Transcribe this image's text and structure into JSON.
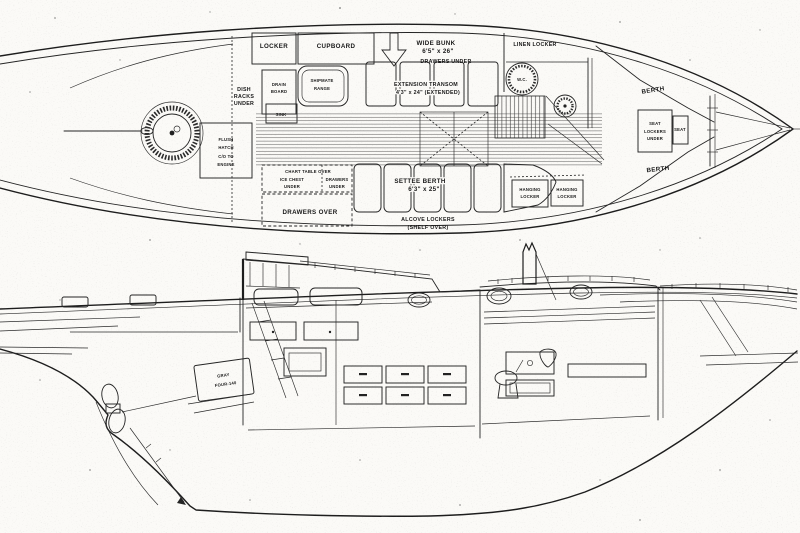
{
  "colors": {
    "ink": "#242424",
    "paper": "#fbfaf7"
  },
  "plan_labels": {
    "locker": "LOCKER",
    "cupboard": "CUPBOARD",
    "wide_bunk_1": "WIDE BUNK",
    "wide_bunk_2": "6'5\" x 26\"",
    "drawers_under_bunk": "DRAWERS UNDER",
    "linen_locker": "LINEN LOCKER",
    "dish_racks_1": "DISH",
    "dish_racks_2": "RACKS",
    "dish_racks_3": "UNDER",
    "drain_board_1": "DRAIN",
    "drain_board_2": "BOARD",
    "stove_1": "SHIPMATE",
    "stove_2": "RANGE",
    "sink": "SINK",
    "extension_transom_1": "EXTENSION TRANSOM",
    "extension_transom_2": "4'3\" x 24\" (EXTENDED)",
    "wc": "W.C.",
    "flush_hatch_1": "FLUSH",
    "flush_hatch_2": "HATCH",
    "flush_hatch_3": "C/O TO",
    "flush_hatch_4": "ENGINE",
    "berth_forward_upper": "BERTH",
    "seat_center": "SEAT",
    "seat_lockers_1": "LOCKERS",
    "seat_lockers_2": "UNDER",
    "seat_small": "SEAT",
    "berth_forward_lower": "BERTH",
    "chart_table_1": "CHART TABLE OVER",
    "chart_table_2": "ICE CHEST",
    "chart_table_3": "UNDER",
    "chart_drawers_1": "DRAWERS",
    "chart_drawers_2": "UNDER",
    "drawers_over": "DRAWERS OVER",
    "settee_berth_1": "SETTEE BERTH",
    "settee_berth_2": "6'3\" x 25\"",
    "alcove_lockers_1": "ALCOVE LOCKERS",
    "alcove_lockers_2": "(SHELF OVER)",
    "hanging_locker_a_1": "HANGING",
    "hanging_locker_a_2": "LOCKER",
    "hanging_locker_b_1": "HANGING",
    "hanging_locker_b_2": "LOCKER"
  },
  "profile_labels": {
    "engine_1": "GRAY",
    "engine_2": "FOUR-140"
  }
}
